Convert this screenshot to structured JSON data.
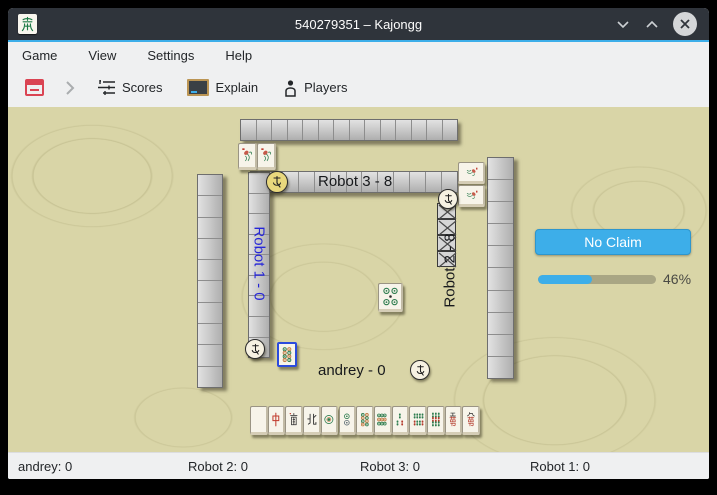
{
  "colors": {
    "accent": "#3daee9",
    "titlebar_bg": "#2f343b",
    "chrome_bg": "#eff0f1",
    "table_bg": "#d9d5a7",
    "claim_button_bg": "#3daee9",
    "robot1_label_color": "#2525d8",
    "abort_icon_red": "#da4453"
  },
  "window": {
    "title": "540279351 – Kajongg",
    "icon": "kajongg-green-dragon",
    "controls": [
      "minimize",
      "maximize",
      "close"
    ]
  },
  "menubar": {
    "items": [
      "Game",
      "View",
      "Settings",
      "Help"
    ]
  },
  "toolbar": {
    "buttons": [
      {
        "name": "abort-game",
        "icon": "abort-game-icon",
        "label": ""
      },
      {
        "name": "next",
        "icon": "chevron-right-icon",
        "label": ""
      },
      {
        "name": "scores",
        "icon": "scores-icon",
        "label": "Scores"
      },
      {
        "name": "explain",
        "icon": "blackboard-icon",
        "label": "Explain"
      },
      {
        "name": "players",
        "icon": "players-icon",
        "label": "Players"
      }
    ]
  },
  "game": {
    "players": [
      {
        "id": "robot3",
        "label": "Robot 3 - 8",
        "side": "top"
      },
      {
        "id": "robot1",
        "label": "Robot 1 - 0",
        "side": "left"
      },
      {
        "id": "robot2",
        "label": "Robot 2 - 8",
        "side": "right"
      },
      {
        "id": "andrey",
        "label": "andrey - 0",
        "side": "bottom"
      }
    ],
    "walls": {
      "outer_top": 14,
      "outer_left": 10,
      "outer_right": 10,
      "inner_top": 13,
      "inner_left": 9
    },
    "robot2_concealed_tiles": 4,
    "bonus_tiles": {
      "robot3": [
        "flower",
        "flower"
      ],
      "robot2": [
        "flower",
        "flower"
      ]
    },
    "center_discard": "circle-5",
    "focused_bonus_tile": "circle-8",
    "hand_tiles": [
      "white-dragon",
      "red-dragon",
      "south-wind",
      "north-wind",
      "circle-1",
      "circle-2",
      "circle-8",
      "circle-9",
      "bamboo-3",
      "bamboo-8",
      "bamboo-9",
      "character-5",
      "character-9"
    ],
    "wind_discs": [
      {
        "player": "robot3",
        "style": "yellow"
      },
      {
        "player": "robot1",
        "style": "white"
      },
      {
        "player": "robot2",
        "style": "white"
      },
      {
        "player": "andrey",
        "style": "white"
      }
    ]
  },
  "claim_panel": {
    "button_label": "No Claim",
    "progress_percent": 46,
    "progress_text": "46%"
  },
  "statusbar": {
    "items": [
      "andrey: 0",
      "Robot 2: 0",
      "Robot 3: 0",
      "Robot 1: 0"
    ]
  }
}
